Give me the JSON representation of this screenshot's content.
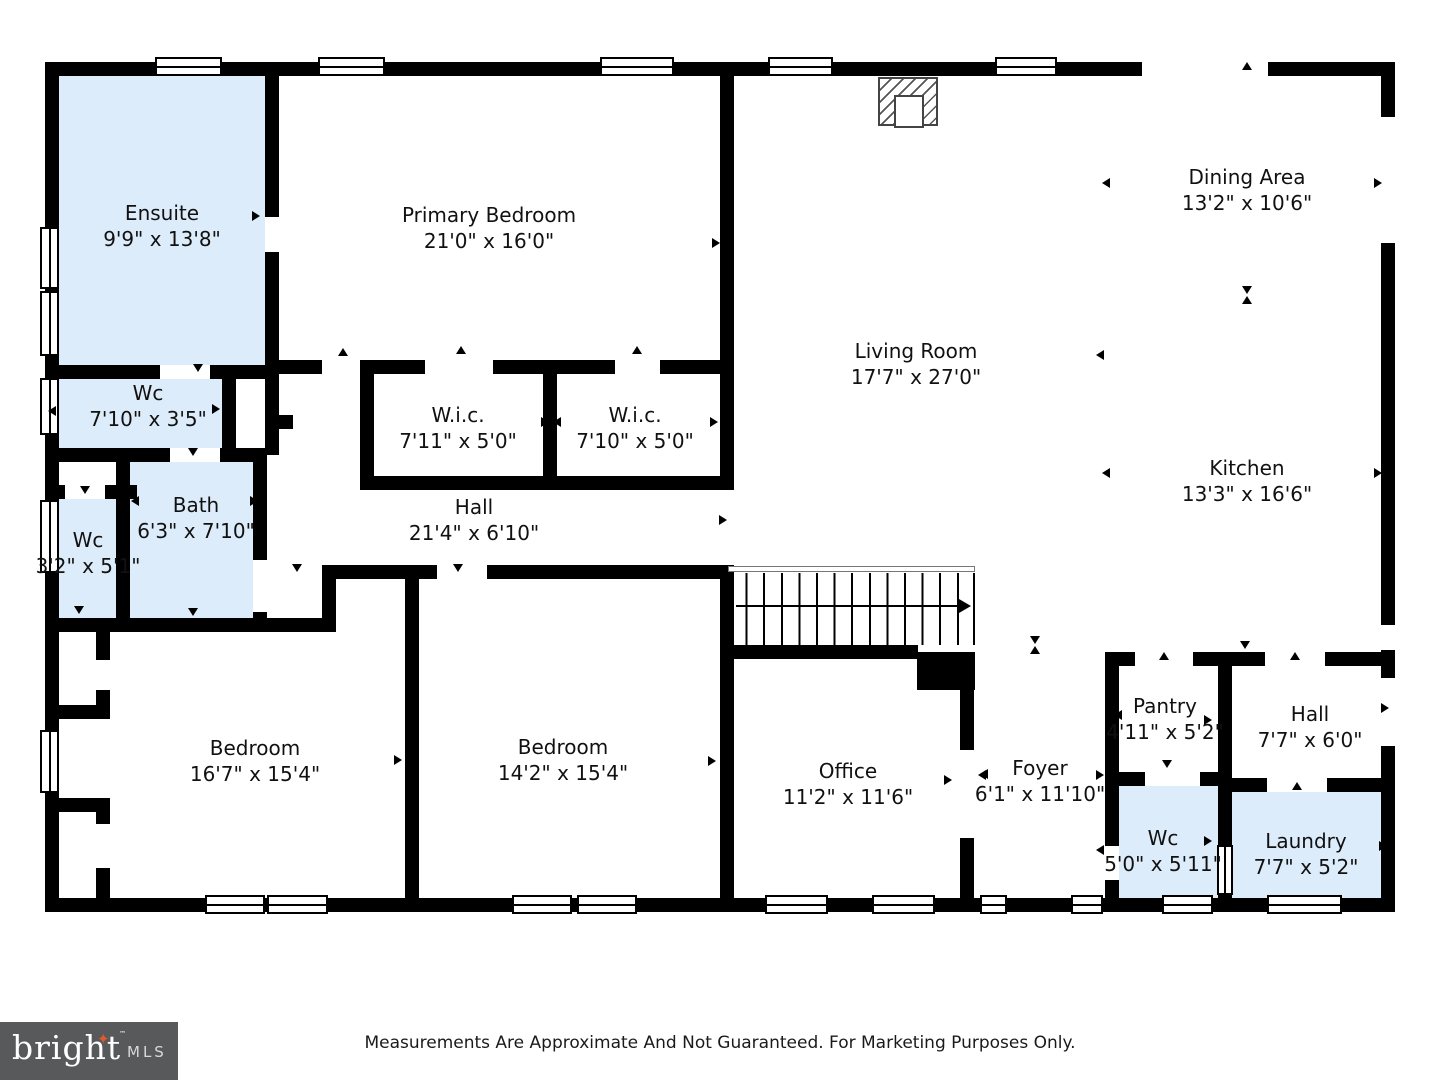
{
  "palette": {
    "wall": "#000000",
    "highlight_fill": "#ddecfa",
    "logo_bg": "#58595b",
    "logo_star": "#e2572b",
    "logo_text": "#ffffff",
    "logo_mls": "#d8d9da"
  },
  "footer": {
    "disclaimer": "Measurements Are Approximate And Not Guaranteed. For Marketing Purposes Only.",
    "logo": {
      "brand": "bright",
      "tm": "™",
      "suffix": "MLS"
    }
  },
  "floorplan": {
    "rooms": [
      {
        "id": "ensuite",
        "name": "Ensuite",
        "dims": "9'9\" x 13'8\"",
        "x": 162,
        "y": 226,
        "highlighted": true
      },
      {
        "id": "primary-bedroom",
        "name": "Primary Bedroom",
        "dims": "21'0\" x 16'0\"",
        "x": 489,
        "y": 228,
        "highlighted": false
      },
      {
        "id": "wc-1",
        "name": "Wc",
        "dims": "7'10\" x 3'5\"",
        "x": 148,
        "y": 406,
        "highlighted": true
      },
      {
        "id": "wc-2",
        "name": "Wc",
        "dims": "3'2\" x 5'1\"",
        "x": 88,
        "y": 553,
        "highlighted": true
      },
      {
        "id": "bath",
        "name": "Bath",
        "dims": "6'3\" x 7'10\"",
        "x": 196,
        "y": 518,
        "highlighted": true
      },
      {
        "id": "wic-1",
        "name": "W.i.c.",
        "dims": "7'11\" x 5'0\"",
        "x": 458,
        "y": 428,
        "highlighted": false
      },
      {
        "id": "wic-2",
        "name": "W.i.c.",
        "dims": "7'10\" x 5'0\"",
        "x": 635,
        "y": 428,
        "highlighted": false
      },
      {
        "id": "hall-1",
        "name": "Hall",
        "dims": "21'4\" x 6'10\"",
        "x": 474,
        "y": 520,
        "highlighted": false
      },
      {
        "id": "living-room",
        "name": "Living Room",
        "dims": "17'7\" x 27'0\"",
        "x": 916,
        "y": 364,
        "highlighted": false
      },
      {
        "id": "dining-area",
        "name": "Dining Area",
        "dims": "13'2\" x 10'6\"",
        "x": 1247,
        "y": 190,
        "highlighted": false
      },
      {
        "id": "kitchen",
        "name": "Kitchen",
        "dims": "13'3\" x 16'6\"",
        "x": 1247,
        "y": 481,
        "highlighted": false
      },
      {
        "id": "bedroom-1",
        "name": "Bedroom",
        "dims": "16'7\" x 15'4\"",
        "x": 255,
        "y": 761,
        "highlighted": false
      },
      {
        "id": "bedroom-2",
        "name": "Bedroom",
        "dims": "14'2\" x 15'4\"",
        "x": 563,
        "y": 760,
        "highlighted": false
      },
      {
        "id": "office",
        "name": "Office",
        "dims": "11'2\" x 11'6\"",
        "x": 848,
        "y": 784,
        "highlighted": false
      },
      {
        "id": "foyer",
        "name": "Foyer",
        "dims": "6'1\" x 11'10\"",
        "x": 1040,
        "y": 781,
        "highlighted": false
      },
      {
        "id": "pantry",
        "name": "Pantry",
        "dims": "4'11\" x 5'2\"",
        "x": 1165,
        "y": 719,
        "highlighted": false
      },
      {
        "id": "hall-2",
        "name": "Hall",
        "dims": "7'7\" x 6'0\"",
        "x": 1310,
        "y": 727,
        "highlighted": false
      },
      {
        "id": "wc-3",
        "name": "Wc",
        "dims": "5'0\" x 5'11\"",
        "x": 1163,
        "y": 851,
        "highlighted": true
      },
      {
        "id": "laundry",
        "name": "Laundry",
        "dims": "7'7\" x 5'2\"",
        "x": 1306,
        "y": 854,
        "highlighted": true
      }
    ],
    "fills": [
      [
        59,
        76,
        206,
        289
      ],
      [
        59,
        379,
        163,
        69
      ],
      [
        59,
        499,
        57,
        119
      ],
      [
        130,
        462,
        123,
        156
      ],
      [
        1119,
        786,
        99,
        112
      ],
      [
        1232,
        792,
        149,
        106
      ]
    ],
    "walls": [
      [
        45,
        62,
        1350,
        14
      ],
      [
        45,
        898,
        1350,
        14
      ],
      [
        45,
        62,
        14,
        850
      ],
      [
        1381,
        62,
        14,
        850
      ],
      [
        265,
        62,
        14,
        155
      ],
      [
        265,
        252,
        14,
        127
      ],
      [
        222,
        379,
        14,
        69
      ],
      [
        265,
        365,
        14,
        90
      ],
      [
        116,
        448,
        14,
        184
      ],
      [
        253,
        448,
        14,
        112
      ],
      [
        253,
        612,
        14,
        20
      ],
      [
        322,
        565,
        14,
        67
      ],
      [
        360,
        360,
        14,
        130
      ],
      [
        543,
        374,
        14,
        102
      ],
      [
        720,
        62,
        14,
        428
      ],
      [
        720,
        565,
        14,
        333
      ],
      [
        405,
        579,
        14,
        319
      ],
      [
        960,
        652,
        14,
        98
      ],
      [
        960,
        838,
        14,
        60
      ],
      [
        917,
        652,
        58,
        38
      ],
      [
        1105,
        652,
        14,
        120
      ],
      [
        1105,
        786,
        14,
        60
      ],
      [
        1105,
        880,
        14,
        32
      ],
      [
        1218,
        652,
        14,
        246
      ],
      [
        45,
        365,
        115,
        14
      ],
      [
        210,
        365,
        69,
        14
      ],
      [
        45,
        448,
        125,
        14
      ],
      [
        220,
        448,
        46,
        14
      ],
      [
        45,
        485,
        20,
        14
      ],
      [
        105,
        485,
        32,
        14
      ],
      [
        45,
        618,
        291,
        14
      ],
      [
        322,
        565,
        115,
        14
      ],
      [
        487,
        565,
        247,
        14
      ],
      [
        279,
        360,
        43,
        14
      ],
      [
        365,
        360,
        60,
        14
      ],
      [
        493,
        360,
        122,
        14
      ],
      [
        660,
        360,
        74,
        14
      ],
      [
        265,
        415,
        28,
        14
      ],
      [
        360,
        476,
        374,
        14
      ],
      [
        728,
        645,
        190,
        14
      ],
      [
        1105,
        652,
        30,
        14
      ],
      [
        1193,
        652,
        72,
        14
      ],
      [
        1325,
        652,
        70,
        14
      ],
      [
        1105,
        772,
        40,
        14
      ],
      [
        1200,
        772,
        32,
        14
      ],
      [
        1218,
        778,
        49,
        14
      ],
      [
        1327,
        778,
        68,
        14
      ],
      [
        45,
        705,
        65,
        14
      ],
      [
        96,
        632,
        14,
        28
      ],
      [
        96,
        690,
        14,
        29
      ],
      [
        45,
        798,
        65,
        14
      ],
      [
        96,
        798,
        14,
        26
      ],
      [
        96,
        868,
        14,
        44
      ]
    ],
    "gaps": [
      [
        1381,
        117,
        14,
        126
      ],
      [
        1381,
        625,
        14,
        25
      ],
      [
        1381,
        678,
        14,
        68
      ],
      [
        1142,
        62,
        126,
        14
      ]
    ],
    "windows": {
      "h": [
        [
          155,
          57,
          67,
          19
        ],
        [
          318,
          57,
          67,
          19
        ],
        [
          600,
          57,
          74,
          19
        ],
        [
          768,
          57,
          65,
          19
        ],
        [
          995,
          57,
          62,
          19
        ],
        [
          205,
          895,
          60,
          19
        ],
        [
          267,
          895,
          61,
          19
        ],
        [
          512,
          895,
          60,
          19
        ],
        [
          577,
          895,
          60,
          19
        ],
        [
          765,
          895,
          63,
          19
        ],
        [
          872,
          895,
          63,
          19
        ],
        [
          980,
          895,
          27,
          19
        ],
        [
          1071,
          895,
          32,
          19
        ],
        [
          1162,
          895,
          51,
          19
        ],
        [
          1267,
          895,
          75,
          19
        ]
      ],
      "v": [
        [
          40,
          227,
          19,
          62
        ],
        [
          40,
          291,
          19,
          65
        ],
        [
          40,
          378,
          19,
          57
        ],
        [
          40,
          500,
          19,
          73
        ],
        [
          40,
          730,
          19,
          63
        ],
        [
          1217,
          845,
          16,
          50
        ]
      ]
    },
    "arrows": [
      [
        198,
        368,
        "down"
      ],
      [
        193,
        452,
        "down"
      ],
      [
        85,
        490,
        "down"
      ],
      [
        343,
        352,
        "up"
      ],
      [
        461,
        350,
        "up"
      ],
      [
        637,
        350,
        "up"
      ],
      [
        297,
        568,
        "down"
      ],
      [
        458,
        568,
        "down"
      ],
      [
        948,
        780,
        "right"
      ],
      [
        984,
        774,
        "left"
      ],
      [
        1164,
        656,
        "up"
      ],
      [
        1295,
        656,
        "up"
      ],
      [
        1167,
        764,
        "down"
      ],
      [
        1297,
        786,
        "up"
      ],
      [
        1385,
        708,
        "right"
      ],
      [
        1247,
        66,
        "up"
      ],
      [
        847,
        655,
        "up"
      ],
      [
        1245,
        645,
        "down"
      ],
      [
        50,
        216,
        "left"
      ],
      [
        256,
        216,
        "right"
      ],
      [
        716,
        243,
        "right"
      ],
      [
        1100,
        355,
        "left"
      ],
      [
        1106,
        183,
        "left"
      ],
      [
        1378,
        183,
        "right"
      ],
      [
        1247,
        290,
        "down"
      ],
      [
        1247,
        300,
        "up"
      ],
      [
        1035,
        640,
        "down"
      ],
      [
        1035,
        650,
        "up"
      ],
      [
        1106,
        473,
        "left"
      ],
      [
        1378,
        473,
        "right"
      ],
      [
        723,
        520,
        "right"
      ],
      [
        52,
        411,
        "left"
      ],
      [
        216,
        409,
        "right"
      ],
      [
        135,
        501,
        "left"
      ],
      [
        254,
        501,
        "right"
      ],
      [
        545,
        422,
        "right"
      ],
      [
        557,
        422,
        "left"
      ],
      [
        714,
        422,
        "right"
      ],
      [
        398,
        760,
        "right"
      ],
      [
        412,
        760,
        "left"
      ],
      [
        712,
        761,
        "right"
      ],
      [
        730,
        778,
        "left"
      ],
      [
        1100,
        775,
        "right"
      ],
      [
        982,
        775,
        "left"
      ],
      [
        1118,
        715,
        "left"
      ],
      [
        1208,
        720,
        "right"
      ],
      [
        1208,
        841,
        "right"
      ],
      [
        1100,
        850,
        "left"
      ],
      [
        1383,
        846,
        "right"
      ],
      [
        79,
        610,
        "down"
      ],
      [
        193,
        612,
        "down"
      ]
    ],
    "stairs": {
      "x": 728,
      "y": 566,
      "w": 247,
      "h": 79
    },
    "fireplace": {
      "x": 878,
      "y": 77,
      "w": 60,
      "h": 49
    }
  }
}
